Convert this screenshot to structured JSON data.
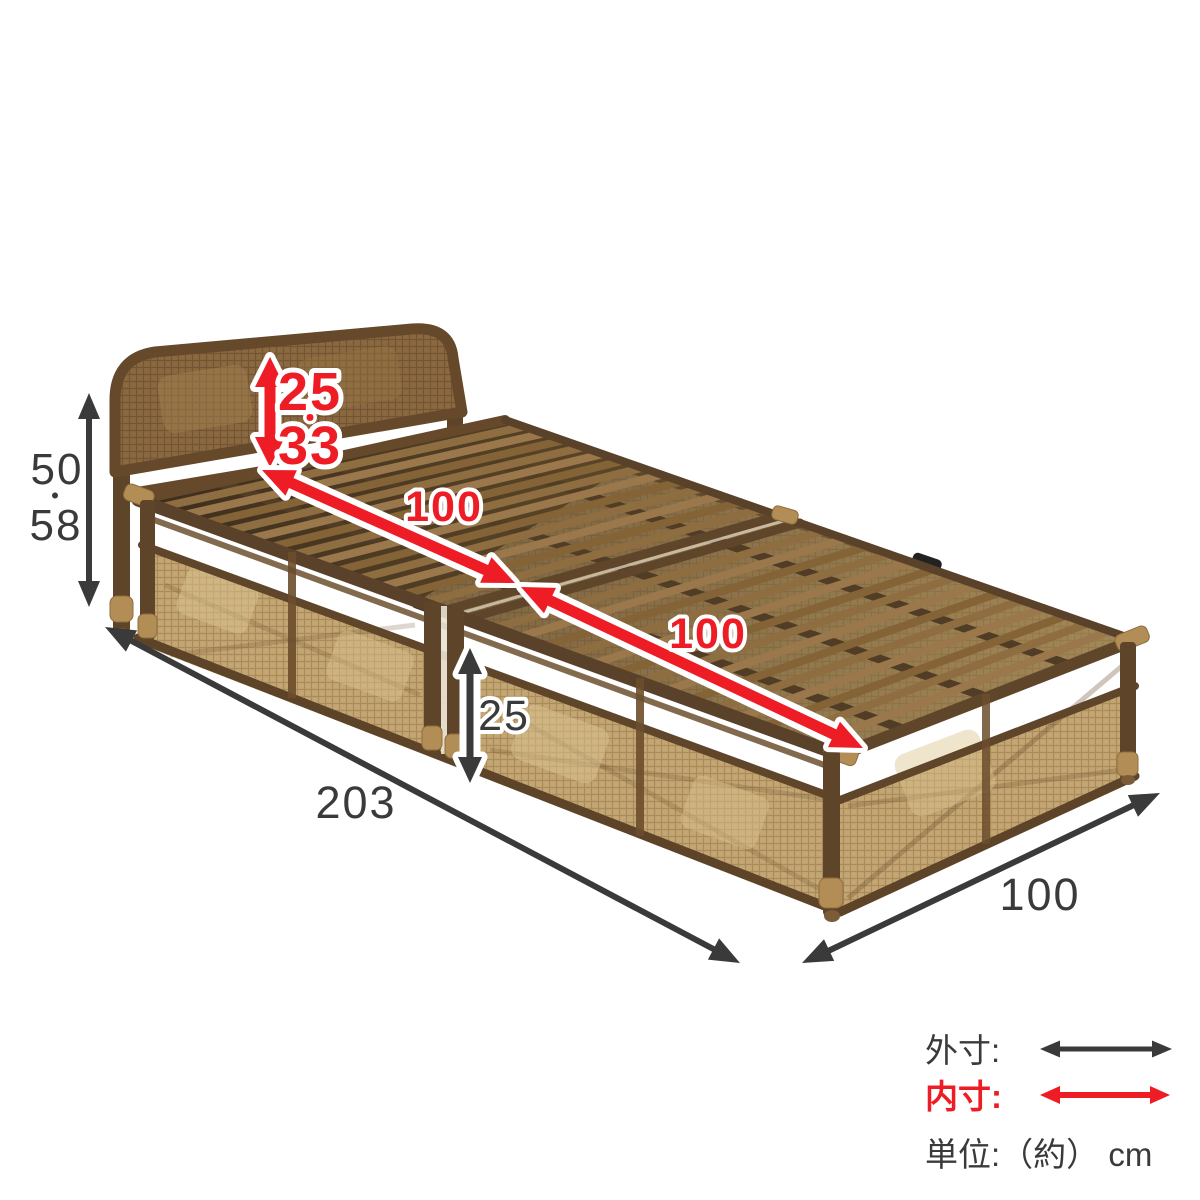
{
  "colors": {
    "outer_dim": "#3a3a3a",
    "inner_dim": "#ee1c24",
    "outline": "#ffffff",
    "background": "#ffffff"
  },
  "measurements": {
    "outer_height": {
      "top": "50",
      "sep": "・",
      "bottom": "58"
    },
    "headboard_inner_height": {
      "top": "25",
      "sep": "・",
      "bottom": "33"
    },
    "inner_length_upper": "100",
    "inner_length_lower": "100",
    "base_height": "25",
    "outer_length": "203",
    "outer_width": "100"
  },
  "legend": {
    "outer_label": "外寸:",
    "inner_label": "内寸:",
    "unit_label": "単位:（約） cm"
  }
}
